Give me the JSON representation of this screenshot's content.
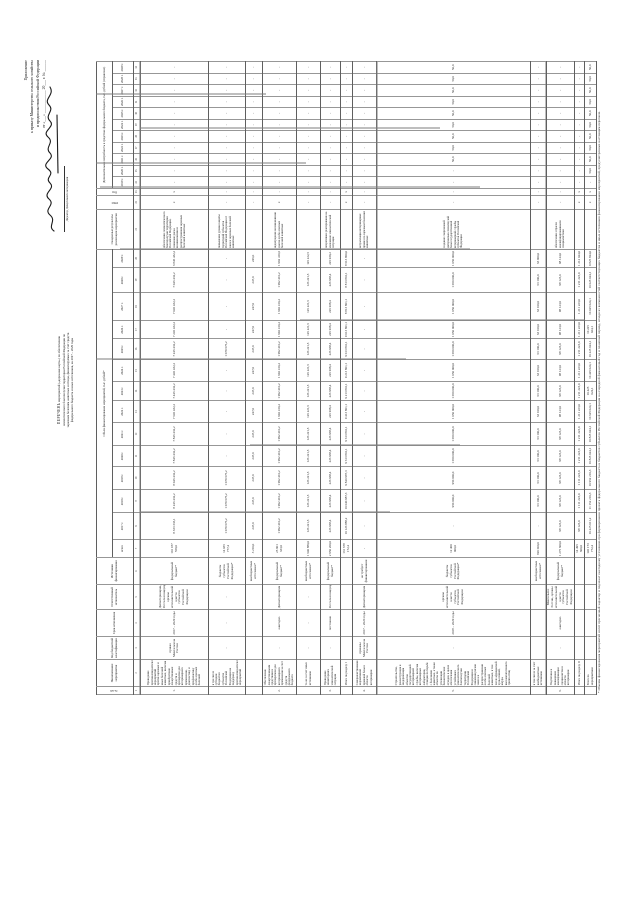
{
  "approval": {
    "lines": [
      "Приложение",
      "к приказу Министерства сельского хозяйства",
      "и продовольствия Российской Федерации",
      "от «___» ____________ 20___ г. № ______"
    ],
    "sign": [
      "Директор Департамента",
      "ветеринарии"
    ]
  },
  "title": {
    "lines": [
      "ПЕРЕЧЕНЬ",
      "мероприятий («дорожная карта»)",
      "по обеспечению эпизоотического благополучия",
      "территории Российской Федерации по заразным",
      "болезням животных и птицы, финансируемых",
      "за счет средств федерального бюджета и иных источников,",
      "на 2017 – 2029 годы"
    ]
  },
  "footnote": {
    "text": "* Объемы финансирования мероприятий носят прогнозный характер и подлежат ежегодному уточнению при формировании проекта федерального бюджета и бюджетов субъектов Российской Федерации на очередной финансовый год и плановый период, исходя из возможностей соответствующих бюджетов и иных источников финансирования мероприятий, предусмотренных настоящим перечнем."
  },
  "colors": {
    "paper": "#ffffff",
    "ink": "#1c1c1c",
    "grid": "#5f5f5f",
    "grid_light": "#979797"
  },
  "table": {
    "header_rows": [
      [
        {
          "t": "№ п/п",
          "rs": 2,
          "v": 1
        },
        {
          "t": "Наименование мероприятия",
          "rs": 2
        },
        {
          "t": "Код бюджетной классификации",
          "rs": 2
        },
        {
          "t": "Срок исполнения",
          "rs": 2
        },
        {
          "t": "Ответственный исполнитель",
          "rs": 2
        },
        {
          "t": "Источники финансирования",
          "rs": 2
        },
        {
          "t": "Объем финансирования мероприятий, тыс. рублей*",
          "cs": 14
        },
        {
          "t": "Ожидаемые результаты реализации мероприятия",
          "rs": 2
        },
        {
          "t": "ГРБС",
          "rs": 2,
          "v": 1
        },
        {
          "t": "Код",
          "rs": 2,
          "v": 1
        },
        {
          "t": "Дополнительная потребность в средствах федерального бюджета, тыс. рублей (справочно)",
          "cs": 11
        }
      ],
      [
        {
          "t": "всего"
        },
        {
          "t": "2017 г."
        },
        {
          "t": "2018 г."
        },
        {
          "t": "2019 г."
        },
        {
          "t": "2020 г."
        },
        {
          "t": "2021 г."
        },
        {
          "t": "2022 г."
        },
        {
          "t": "2023 г."
        },
        {
          "t": "2024 г."
        },
        {
          "t": "2025 г."
        },
        {
          "t": "2026 г."
        },
        {
          "t": "2027 г."
        },
        {
          "t": "2028 г."
        },
        {
          "t": "2029 г."
        },
        {
          "t": "2019 г."
        },
        {
          "t": "2020 г."
        },
        {
          "t": "2021 г."
        },
        {
          "t": "2022 г."
        },
        {
          "t": "2023 г."
        },
        {
          "t": "2024 г."
        },
        {
          "t": "2025 г."
        },
        {
          "t": "2026 г."
        },
        {
          "t": "2027 г."
        },
        {
          "t": "2028 г."
        },
        {
          "t": "2029 г."
        }
      ]
    ],
    "index_row": [
      "1",
      "2",
      "3",
      "4",
      "5",
      "6",
      "7",
      "8",
      "9",
      "10",
      "11",
      "12",
      "13",
      "14",
      "15",
      "16",
      "17",
      "18",
      "19",
      "20",
      "21",
      "22",
      "23",
      "24",
      "25",
      "26",
      "27",
      "28",
      "29",
      "30",
      "31",
      "32",
      "33",
      "34"
    ],
    "rows": [
      {
        "cells": [
          "1.",
          "Проведение противоэпизоотических мероприятий против заразных и иных болезней животных, включая приобретение лекарственных средств и препаратов для ветеринарного применения, диагностику и профилактику особо опасных болезней",
          "приказ Минсельхоза России",
          "2017 – 2029 годы",
          "Депветеринария, Россельхознадзор, органы исполнительной власти субъектов Российской Федерации",
          "федеральный бюджет*",
          "101 187 559,0",
          "8 333 333,1",
          "8 246 432,2",
          "8 046 432,2",
          "7 846 432,2",
          "7 846 432,2",
          "7 646 432,2",
          "7 446 432,2",
          "7 446 432,2",
          "7 246 432,2",
          "7 246 432,2",
          "7 046 432,2",
          "7 046 432,2",
          "6 846 432,2",
          "обеспечение эпизоотического благополучия территории Российской Федерации, снижение риска возникновения и распространения заразных болезней животных",
          "х",
          "х"
        ]
      },
      {
        "cells": [
          "",
          "в том числе субсидии бюджетам субъектов Российской Федерации на поддержку противоэпизоотических мероприятий",
          "-",
          "-",
          "-",
          "бюджеты субъектов Российской Федерации*",
          "14 035 777,4",
          "1 079 675,2",
          "1 079 675,2",
          "1 079 675,2",
          "-",
          "-",
          "-",
          "-",
          "-",
          "1 079 675,2",
          "-",
          "-",
          "-",
          "-",
          "повышение уровня защиты территорий субъектов Российской Федерации от заноса заразных болезней животных",
          "-",
          "-"
        ]
      },
      {
        "cells": [
          "",
          "",
          "",
          "",
          "",
          "внебюджетные источники*",
          "3 210,0",
          "247,0",
          "247,0",
          "247,0",
          "247,0",
          "247,0",
          "247,0",
          "247,0",
          "247,0",
          "247,0",
          "247,0",
          "247,0",
          "247,0",
          "246,0",
          "",
          "-",
          "-"
        ]
      },
      {
        "cells": [
          "2.",
          "Обеспечение лекарственными средствами и препаратами для ветеринарного применения за счет средств федерального бюджета",
          "-",
          "ежегодно",
          "Депветеринария",
          "федеральный бюджет*",
          "25 901 333,0",
          "1 992 410,2",
          "1 992 410,2",
          "1 992 410,2",
          "1 992 410,2",
          "1 992 410,2",
          "1 992 410,2",
          "1 992 410,2",
          "1 992 410,2",
          "1 992 410,2",
          "1 992 410,2",
          "1 992 410,2",
          "1 992 410,2",
          "1 992 410,6",
          "недопущение возникновения очагов особо опасных болезней животных",
          "х",
          "-"
        ]
      },
      {
        "cells": [
          "",
          "то же за счет иных источников",
          "-",
          "-",
          "-",
          "внебюджетные источники*",
          "1 640 880,0",
          "126 221,5",
          "126 221,5",
          "126 221,5",
          "126 221,5",
          "126 221,5",
          "126 221,5",
          "126 221,5",
          "126 221,5",
          "126 221,5",
          "126 221,5",
          "126 221,5",
          "126 221,5",
          "126 222,5",
          "",
          "-",
          "-"
        ]
      },
      {
        "cells": [
          "3.",
          "Проведение мониторинга эпизоотической ситуации",
          "-",
          "постоянно",
          "Россельхознадзор",
          "федеральный бюджет*",
          "2 950 200,0",
          "226 938,4",
          "226 938,4",
          "226 938,4",
          "226 938,4",
          "226 938,4",
          "226 938,4",
          "226 938,4",
          "226 938,4",
          "226 938,4",
          "226 938,4",
          "226 938,4",
          "226 938,4",
          "226 939,2",
          "оперативное реагирование на изменение эпизоотической ситуации",
          "-",
          "-"
        ]
      },
      {
        "cells": [
          "",
          "Итого по разделу I",
          "",
          "",
          "",
          "",
          "131 678 172,4",
          "10 126 888,2",
          "10 040 987,3",
          "9 840 987,3",
          "9 613 801,1",
          "9 613 801,1",
          "9 413 801,1",
          "9 213 801,1",
          "9 213 801,1",
          "9 013 801,1",
          "9 013 801,1",
          "8 813 801,1",
          "8 813 801,1",
          "8 613 800,0",
          "",
          "х",
          "х"
        ]
      },
      {
        "cells": [
          "4.",
          "Совершенствование нормативной правовой базы в области ветеринарии",
          "приказы Минсельхоза России",
          "2017 – 2020 годы",
          "Депветеринария",
          "не требует финансирования",
          "-",
          "-",
          "-",
          "-",
          "-",
          "-",
          "-",
          "-",
          "-",
          "-",
          "-",
          "-",
          "-",
          "-",
          "актуализация ветеринарных правил по заразным болезням животных",
          "-",
          "-"
        ]
      },
      {
        "cells": [
          "5.",
          "Строительство, реконструкция и модернизация объектов государственной ветеринарной службы, включая ветеринарные лаборатории, станции по борьбе с болезнями животных, а также объекты по утилизации биологических отходов, в целях обеспечения устойчивого эпизоотического благополучия территории Российской Федерации и снижения рисков заноса и распространения особо опасных болезней животных, в том числе африканской чумы свиней, ящура, высокопатогенного гриппа птиц",
          "-",
          "2018 – 2029 годы",
          "органы исполнительной власти субъектов Российской Федерации",
          "бюджеты субъектов Российской Федерации*",
          "12 400 000,0",
          "-",
          "950 000,0",
          "950 000,0",
          "1 050 000,0",
          "1 050 000,0",
          "1 050 000,0",
          "1 050 000,0",
          "1 050 000,0",
          "1 050 000,0",
          "1 050 000,0",
          "1 050 000,0",
          "1 050 000,0",
          "1 050 000,0",
          "создание современной материально-технической базы государственной ветеринарной службы субъектов Российской Федерации",
          "-",
          "-"
        ],
        "extra": [
          "-",
          "-",
          "50,0",
          "50,0",
          "50,0",
          "50,0",
          "50,0",
          "50,0",
          "50,0",
          "50,0",
          "50,0"
        ]
      },
      {
        "cells": [
          "",
          "в том числе за счет внебюджетных источников",
          "",
          "",
          "",
          "внебюджетные источники*",
          "820 000,0",
          "-",
          "63 100,0",
          "63 100,0",
          "63 100,0",
          "63 100,0",
          "63 100,0",
          "63 100,0",
          "63 100,0",
          "63 100,0",
          "63 100,0",
          "63 100,0",
          "63 100,0",
          "63 900,0",
          "",
          "-",
          "-"
        ]
      },
      {
        "cells": [
          "6.",
          "Подготовка и повышение квалификации специалистов в области ветеринарии",
          "-",
          "ежегодно",
          "Минсельхоз России, органы исполнительной власти субъектов Российской Федерации",
          "федеральный бюджет*",
          "1 275 600,0",
          "98 123,0",
          "98 123,0",
          "98 123,0",
          "98 123,0",
          "98 123,0",
          "98 123,0",
          "98 123,0",
          "98 123,0",
          "98 123,0",
          "98 123,0",
          "98 123,0",
          "98 123,0",
          "98 124,0",
          "обеспечение отрасли квалифицированными специалистами",
          "-",
          "-"
        ]
      },
      {
        "cells": [
          "",
          "Итого по разделу II",
          "",
          "",
          "",
          "",
          "14 495 600,0",
          "98 123,0",
          "1 111 223,0",
          "1 111 223,0",
          "1 211 223,0",
          "1 211 223,0",
          "1 211 223,0",
          "1 211 223,0",
          "1 211 223,0",
          "1 211 223,0",
          "1 211 223,0",
          "1 211 223,0",
          "1 211 223,0",
          "1 212 024,0",
          "",
          "х",
          "х"
        ]
      },
      {
        "cells": [
          "",
          "Всего по мероприятиям",
          "",
          "",
          "",
          "",
          "146 173 772,4",
          "10 225 011,2",
          "11 152 210,3",
          "10 952 210,3",
          "10 825 024,1",
          "10 825 024,1",
          "10 625 024,1",
          "10 425 024,1",
          "10 425 024,1",
          "10 225 024,1",
          "10 225 024,1",
          "10 025 024,1",
          "10 025 024,1",
          "9 825 824,0",
          "",
          "х",
          "х"
        ],
        "extra": [
          "-",
          "50,0",
          "50,0",
          "50,0",
          "50,0",
          "50,0",
          "50,0",
          "50,0",
          "50,0",
          "50,0",
          "50,0"
        ]
      }
    ]
  }
}
